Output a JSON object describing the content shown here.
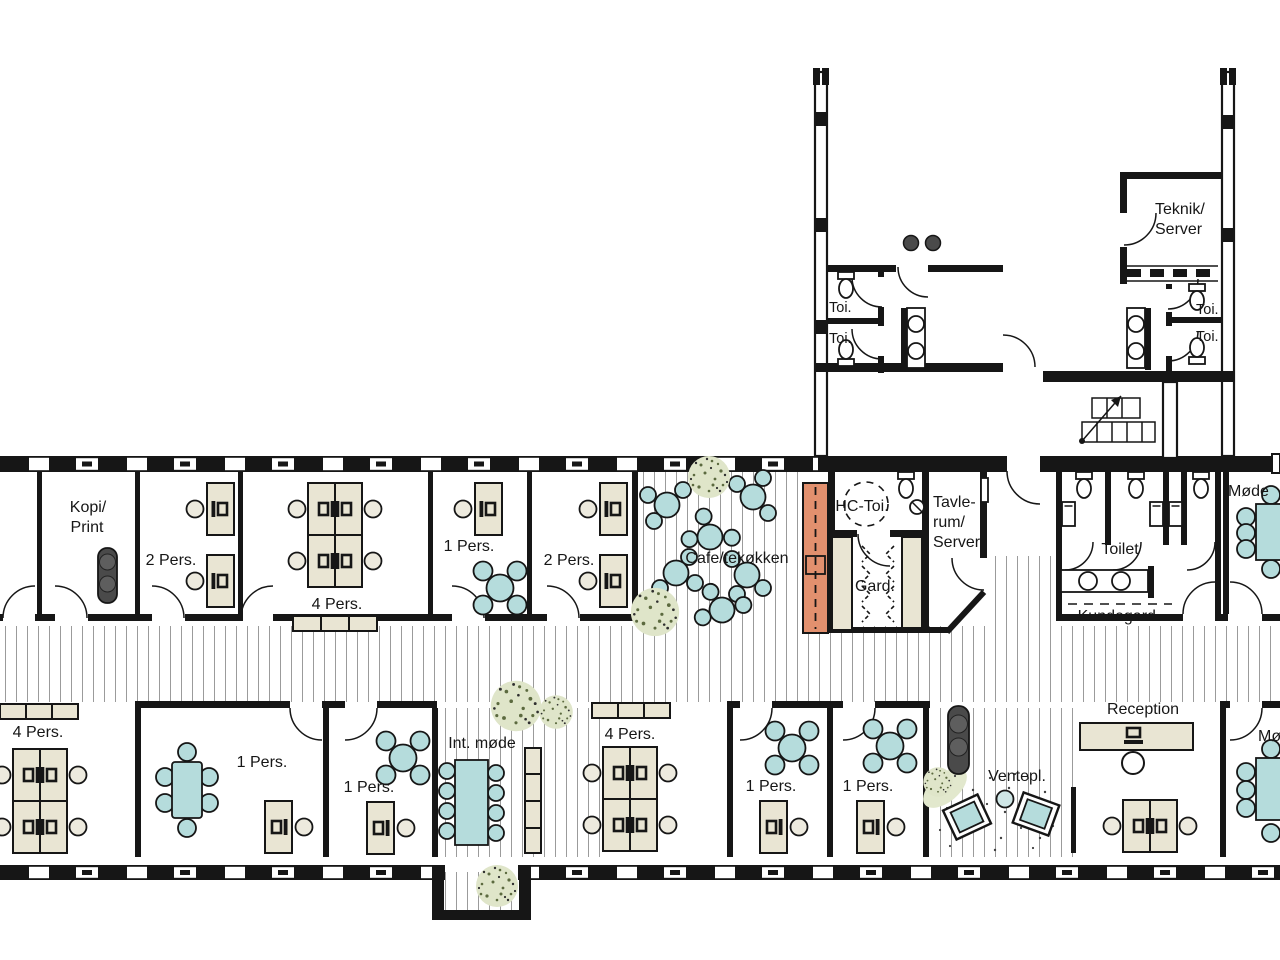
{
  "drawing_title": "Office floor plan",
  "colors": {
    "wall": "#161616",
    "beige": "#e9e5d3",
    "teal": "#b5dcdc",
    "chair": "#edeade",
    "orange": "#e2906e",
    "dark": "#4a4a4a",
    "hatch": "#9b9b9b",
    "plant": "#dfe5c9",
    "dot": "#5c6a3f"
  },
  "labels": {
    "kopi_print": [
      "Kopi/",
      "Print"
    ],
    "two_pers": "2 Pers.",
    "four_pers": "4 Pers.",
    "one_pers": "1 Pers.",
    "cafe": "Cafe/tekøkken",
    "hc_toi": "HC-Toi.",
    "tavlerum": [
      "Tavle-",
      "rum/",
      "Server"
    ],
    "gard": "Gard.",
    "toilet": "Toilet",
    "kundegard": "Kundegard.",
    "mode": "Møde",
    "teknik": [
      "Teknik/",
      "Server"
    ],
    "toi": "Toi.",
    "int_mode": "Int. møde",
    "ventepl": "Ventepl.",
    "reception": "Reception"
  }
}
